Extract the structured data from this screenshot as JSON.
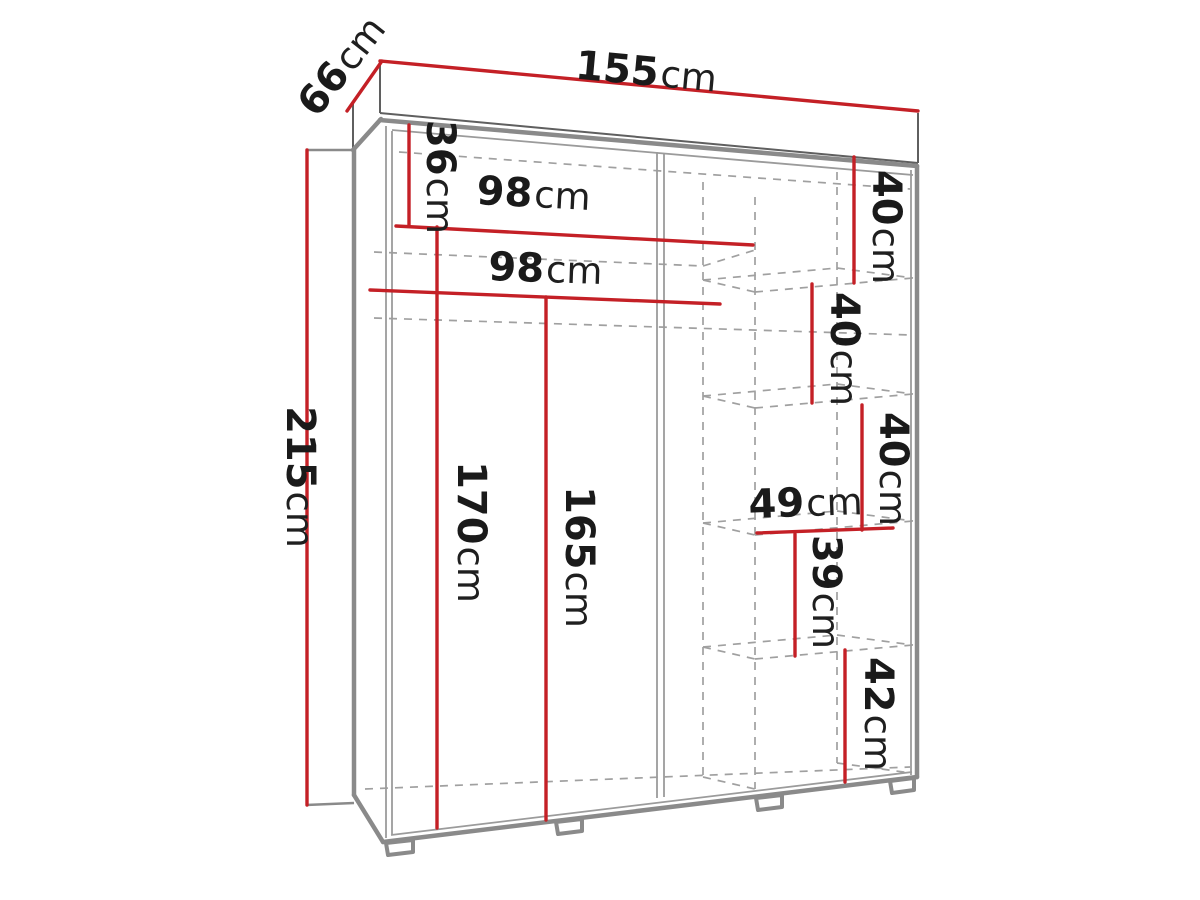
{
  "diagram": {
    "name": "wardrobe-dimension-diagram",
    "unit": "cm",
    "colors": {
      "dimension_line": "#c42026",
      "outline_thick": "#8a8a8a",
      "outline_thin": "#9b9b9b",
      "slab_edge": "#5f5f5f",
      "hidden_edge": "#a0a0a0",
      "label_text": "#1a1a1a",
      "background": "#ffffff"
    },
    "dimensions": {
      "width": {
        "value": "155",
        "unit": "cm"
      },
      "depth": {
        "value": "66",
        "unit": "cm"
      },
      "height": {
        "value": "215",
        "unit": "cm"
      },
      "top_shelf_drop": {
        "value": "36",
        "unit": "cm"
      },
      "inner_width_upper": {
        "value": "98",
        "unit": "cm"
      },
      "inner_width_lower": {
        "value": "98",
        "unit": "cm"
      },
      "hanging_left": {
        "value": "170",
        "unit": "cm"
      },
      "hanging_right": {
        "value": "165",
        "unit": "cm"
      },
      "shelf_gap_1": {
        "value": "40",
        "unit": "cm"
      },
      "shelf_gap_2": {
        "value": "40",
        "unit": "cm"
      },
      "shelf_gap_3": {
        "value": "40",
        "unit": "cm"
      },
      "shelf_width": {
        "value": "49",
        "unit": "cm"
      },
      "shelf_gap_4": {
        "value": "39",
        "unit": "cm"
      },
      "shelf_gap_5": {
        "value": "42",
        "unit": "cm"
      }
    }
  }
}
